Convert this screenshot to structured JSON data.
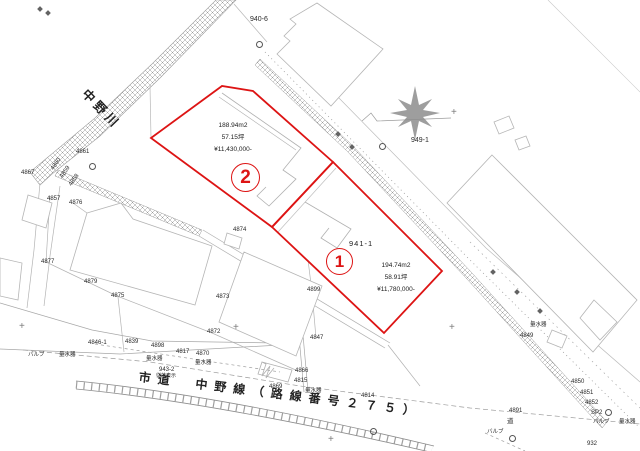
{
  "colors": {
    "parcel_outline": "#dd1414",
    "linework_gray": "#a8a8a8",
    "text_dark": "#1c1c1c"
  },
  "parcels": [
    {
      "number": "1",
      "lot_number": "941-1",
      "area_m2": "194.74m2",
      "area_tsubo": "58.91坪",
      "price": "¥11,780,000-"
    },
    {
      "number": "2",
      "area_m2": "188.94m2",
      "area_tsubo": "57.15坪",
      "price": "¥11,430,000-"
    }
  ],
  "river": {
    "name": "中野川"
  },
  "road": {
    "name": "市道　中野線（路線番号２７５）"
  },
  "point_labels": [
    {
      "text": "940-6",
      "x": 250,
      "y": 16,
      "size": 7
    },
    {
      "text": "949-1",
      "x": 411,
      "y": 137,
      "size": 7
    },
    {
      "text": "4861",
      "x": 76,
      "y": 149
    },
    {
      "text": "4860",
      "x": 50,
      "y": 168,
      "rot": -55
    },
    {
      "text": "4859",
      "x": 59,
      "y": 176,
      "rot": -55
    },
    {
      "text": "4858",
      "x": 68,
      "y": 184,
      "rot": -55
    },
    {
      "text": "4867",
      "x": 21,
      "y": 170
    },
    {
      "text": "4857",
      "x": 47,
      "y": 196
    },
    {
      "text": "4876",
      "x": 69,
      "y": 200
    },
    {
      "text": "4877",
      "x": 41,
      "y": 259
    },
    {
      "text": "4879",
      "x": 84,
      "y": 279
    },
    {
      "text": "4875",
      "x": 111,
      "y": 293
    },
    {
      "text": "4874",
      "x": 233,
      "y": 227
    },
    {
      "text": "4873",
      "x": 216,
      "y": 294
    },
    {
      "text": "4872",
      "x": 207,
      "y": 329
    },
    {
      "text": "4899",
      "x": 307,
      "y": 287
    },
    {
      "text": "4847",
      "x": 310,
      "y": 335
    },
    {
      "text": "4846-1",
      "x": 88,
      "y": 340
    },
    {
      "text": "4839",
      "x": 125,
      "y": 339
    },
    {
      "text": "バルブ",
      "x": 28,
      "y": 353,
      "size": 5.5
    },
    {
      "text": "量水器",
      "x": 59,
      "y": 353,
      "size": 5.5
    },
    {
      "text": "4898",
      "x": 151,
      "y": 343
    },
    {
      "text": "4817",
      "x": 176,
      "y": 349
    },
    {
      "text": "4870",
      "x": 196,
      "y": 351
    },
    {
      "text": "量水器",
      "x": 146,
      "y": 357,
      "size": 5.5
    },
    {
      "text": "量水器",
      "x": 195,
      "y": 361,
      "size": 5.5
    },
    {
      "text": "943-2",
      "x": 159,
      "y": 367
    },
    {
      "text": "従前表示",
      "x": 156,
      "y": 374,
      "size": 5
    },
    {
      "text": "4866",
      "x": 295,
      "y": 368
    },
    {
      "text": "4815",
      "x": 294,
      "y": 378
    },
    {
      "text": "4869",
      "x": 269,
      "y": 384
    },
    {
      "text": "量水器",
      "x": 305,
      "y": 389,
      "size": 5.5
    },
    {
      "text": "4814",
      "x": 361,
      "y": 393
    },
    {
      "text": "量水器",
      "x": 530,
      "y": 323,
      "size": 5.5
    },
    {
      "text": "4849",
      "x": 520,
      "y": 333
    },
    {
      "text": "4850",
      "x": 571,
      "y": 379
    },
    {
      "text": "4851",
      "x": 580,
      "y": 390
    },
    {
      "text": "4852",
      "x": 585,
      "y": 400
    },
    {
      "text": "SP2",
      "x": 591,
      "y": 410
    },
    {
      "text": "4891",
      "x": 509,
      "y": 408
    },
    {
      "text": "道",
      "x": 507,
      "y": 419,
      "size": 6.5
    },
    {
      "text": "バルブ",
      "x": 593,
      "y": 420,
      "size": 5.5
    },
    {
      "text": "量水器",
      "x": 619,
      "y": 420,
      "size": 5.5
    },
    {
      "text": "バルブ",
      "x": 487,
      "y": 430,
      "size": 5.5
    },
    {
      "text": "932",
      "x": 587,
      "y": 441
    }
  ],
  "symbols": {
    "circle_markers": [
      {
        "x": 379,
        "y": 143
      },
      {
        "x": 256,
        "y": 41
      },
      {
        "x": 605,
        "y": 409
      },
      {
        "x": 509,
        "y": 435
      },
      {
        "x": 89,
        "y": 163
      },
      {
        "x": 370,
        "y": 428
      }
    ],
    "cross_markers": [
      {
        "x": 451,
        "y": 108
      },
      {
        "x": 449,
        "y": 323
      },
      {
        "x": 233,
        "y": 323
      },
      {
        "x": 19,
        "y": 322
      },
      {
        "x": 328,
        "y": 435
      }
    ],
    "pole_markers": [
      {
        "x": 491,
        "y": 270
      },
      {
        "x": 515,
        "y": 290
      },
      {
        "x": 336,
        "y": 132
      },
      {
        "x": 350,
        "y": 145
      },
      {
        "x": 538,
        "y": 309
      },
      {
        "x": 38,
        "y": 7
      },
      {
        "x": 46,
        "y": 11
      }
    ]
  }
}
